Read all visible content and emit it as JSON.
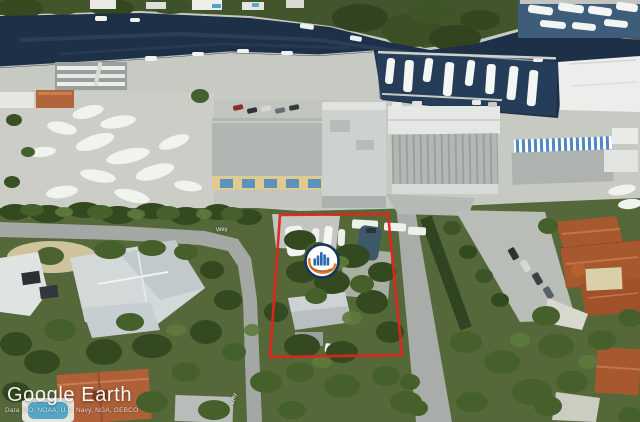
{
  "app": {
    "title": "Google Earth"
  },
  "watermark": {
    "title": "Google Earth",
    "attribution": "Data SIO, NOAA, U.S. Navy, NGA, GEBCO"
  },
  "overlay": {
    "boundary_color": "#e3241b",
    "marker": {
      "name": "company-logo-placemark",
      "fill_color": "#ffffff",
      "ring_color": "#17355c",
      "bar_color": "#2b67ae",
      "swoosh_color": "#dd7b27",
      "swoosh_shadow_color": "#a8511c"
    }
  },
  "scene": {
    "water_color": "#1d3047",
    "water_color_right": "#3d5d7b",
    "marina_water_color": "#27405c"
  },
  "street_labels": [
    {
      "text": "Way"
    },
    {
      "text": "Way"
    }
  ]
}
